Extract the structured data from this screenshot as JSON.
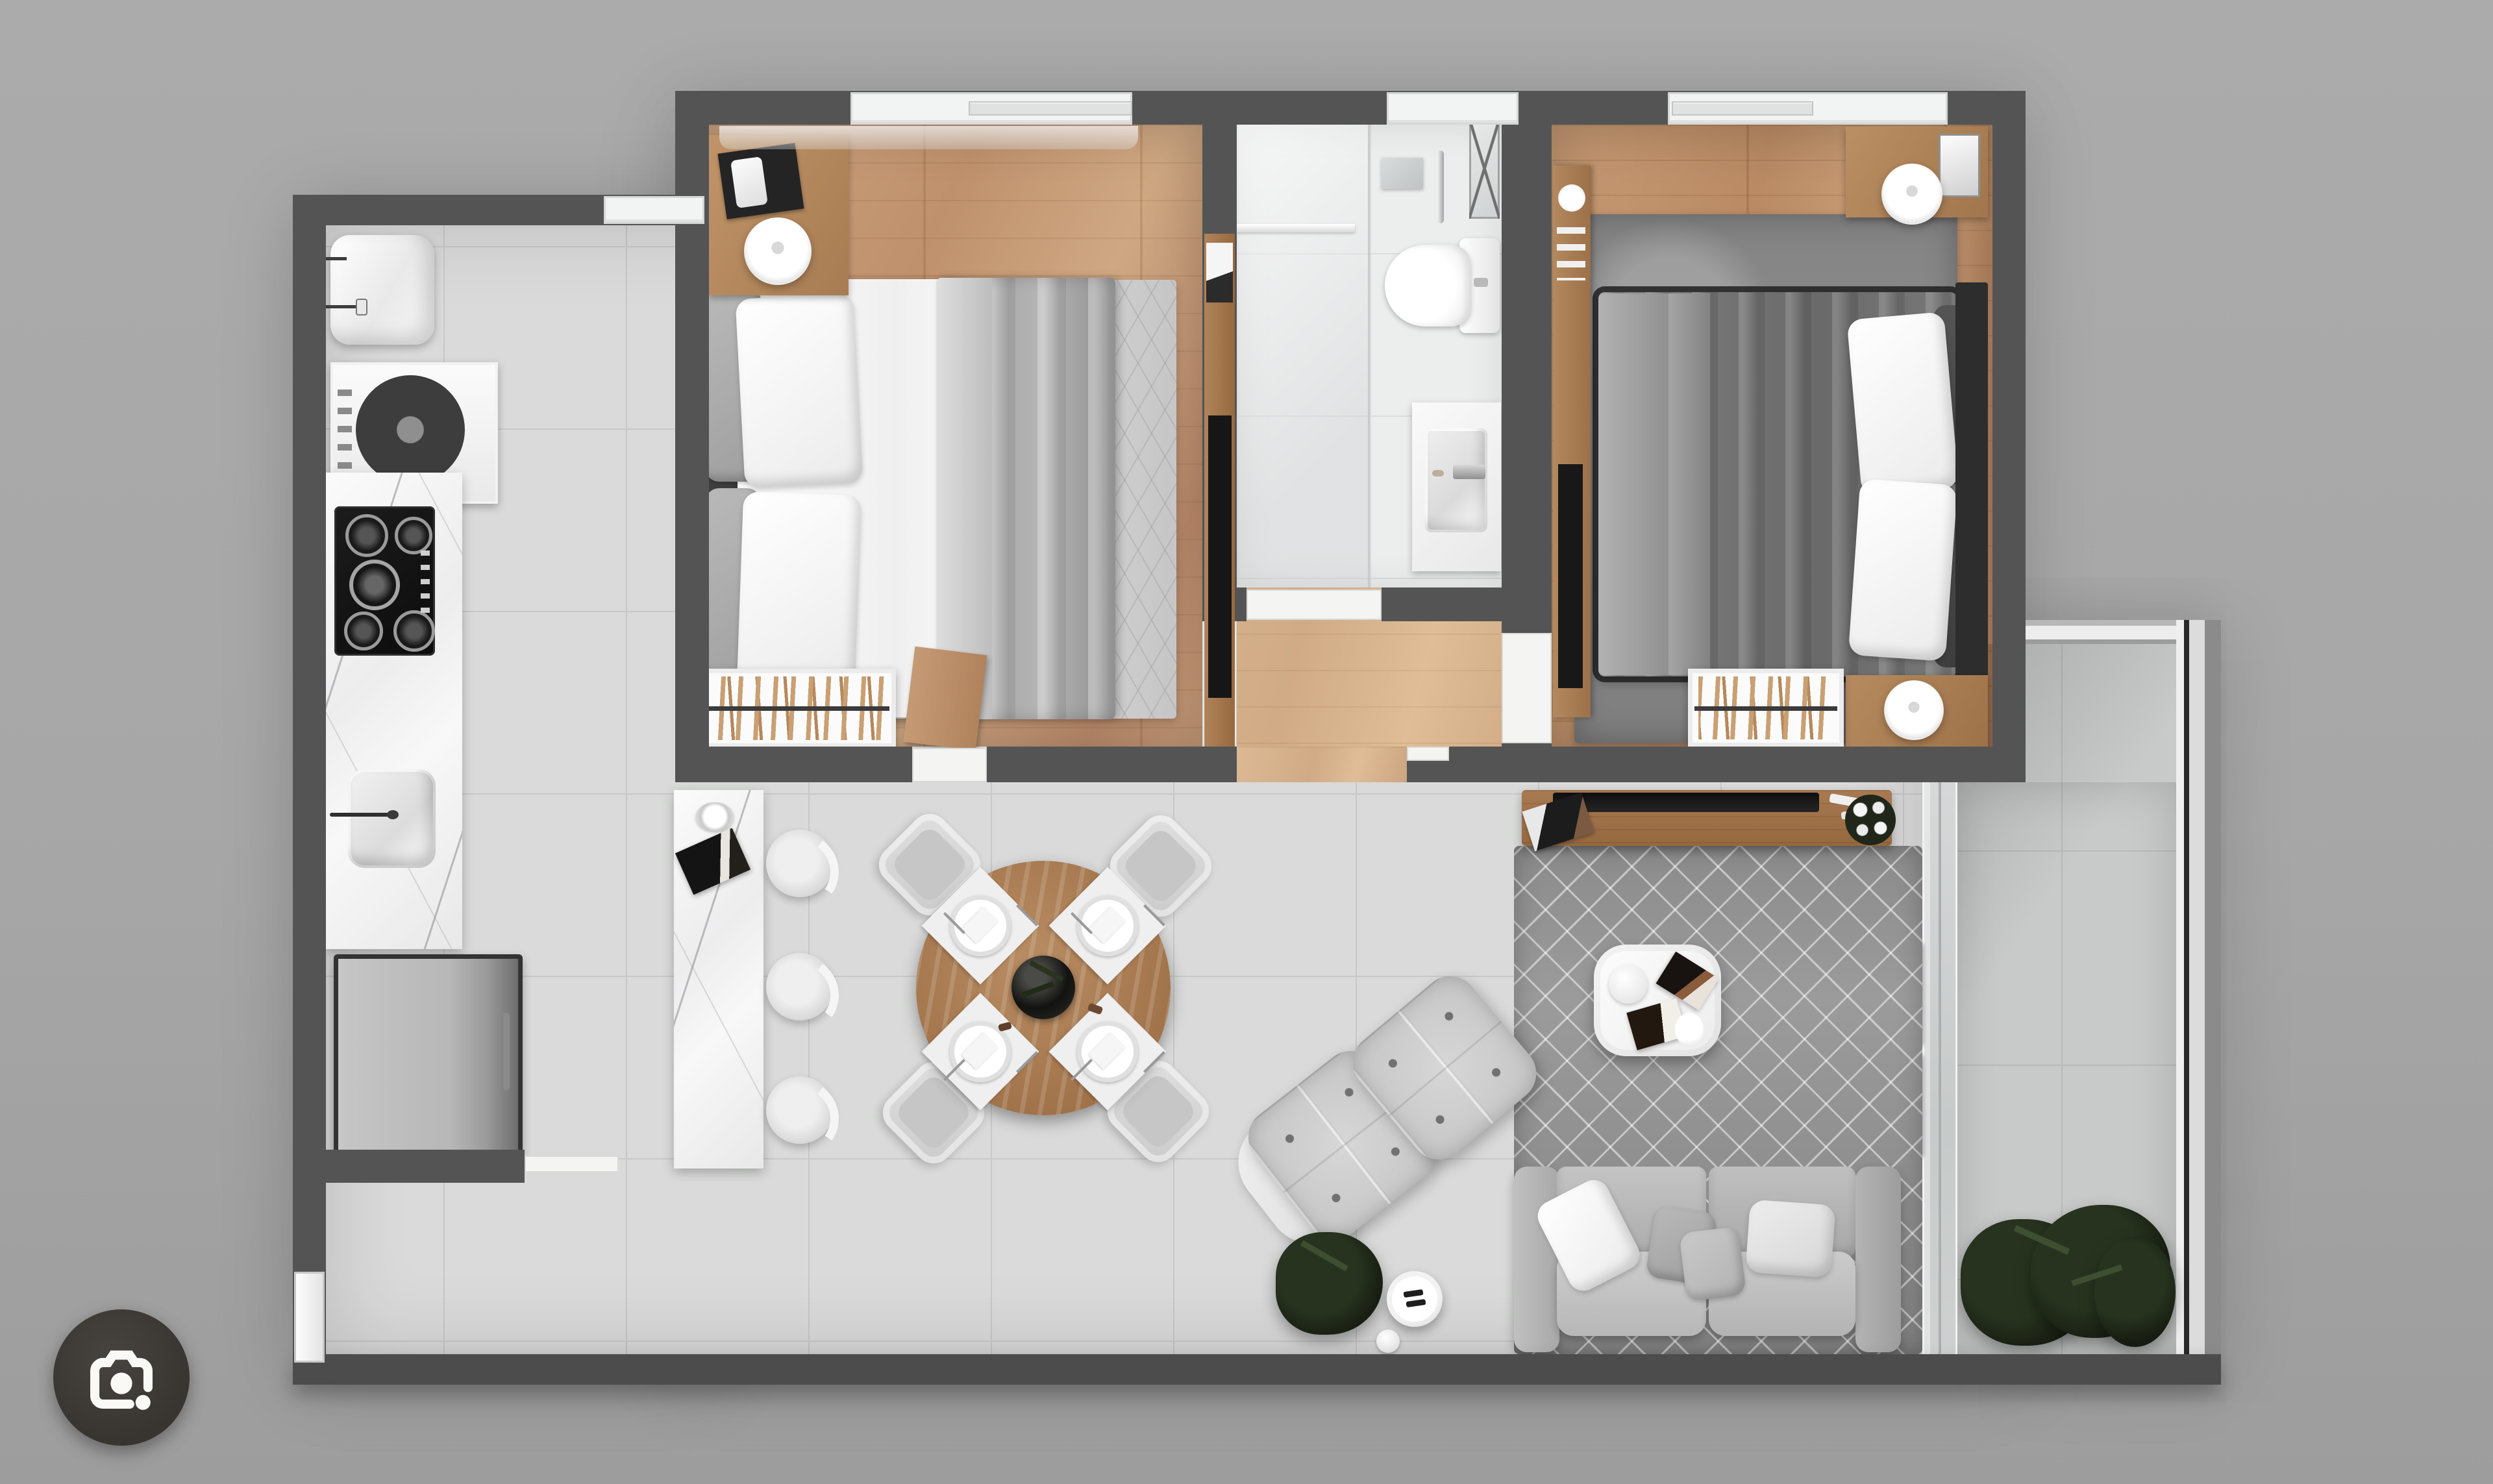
{
  "app": {
    "kind": "image-viewer-with-lens-overlay",
    "lens_button": {
      "icon": "camera-lens-icon",
      "background": "#383531",
      "glyph_color": "#fbf9f6"
    }
  },
  "palette": {
    "page_background": "#a7a7a7",
    "wall": "#545454",
    "wood_floor_bedroom1": "#c59a78",
    "wood_floor_bedroom2": "#bf9270",
    "wood_floor_hallway": "#d6b28c",
    "tile_living": "#d9dad9",
    "tile_bathroom": "#eceded",
    "tile_balcony": "#c8cac9",
    "marble_counter": "#f2f2f2",
    "rug_bedroom1": "#dcdcdc",
    "rug_bedroom2": "#8d8d8d",
    "rug_living": "#9b9b9b",
    "sofa": "#b8b8b8",
    "armchair": "#cfcfcf",
    "duvet_bedroom1": "#aeaeae",
    "duvet_bedroom2": "#6e6e6e",
    "console_wood": "#9b6e4c",
    "dining_table_wood": "#ab7d57",
    "plant": "#1d2417",
    "window_frame": "#f2f3f3",
    "threshold": "#f4f4f3"
  },
  "floorplan": {
    "type": "two-bedroom-apartment-top-down-3d-render",
    "rooms": [
      {
        "id": "kitchen"
      },
      {
        "id": "bedroom-1"
      },
      {
        "id": "bathroom"
      },
      {
        "id": "hallway"
      },
      {
        "id": "bedroom-2"
      },
      {
        "id": "living-dining"
      },
      {
        "id": "balcony"
      }
    ],
    "furniture": [
      "kitchen-sink",
      "washing-machine",
      "gas-cooktop",
      "counter-sink",
      "refrigerator",
      "breakfast-bar",
      "bar-stools",
      "dining-table-with-four-settings",
      "dining-chairs",
      "double-bed-1",
      "double-bed-2",
      "nightstands-with-lamps",
      "bookshelves",
      "wardrobe-tv-panel",
      "toilet",
      "shower-area",
      "vanity-sink",
      "towel-ladder",
      "sofa-with-pillows",
      "tufted-armchairs",
      "coffee-table",
      "side-table",
      "tv-console",
      "potted-plants",
      "sliding-glass-door",
      "windows",
      "entry-door"
    ]
  }
}
